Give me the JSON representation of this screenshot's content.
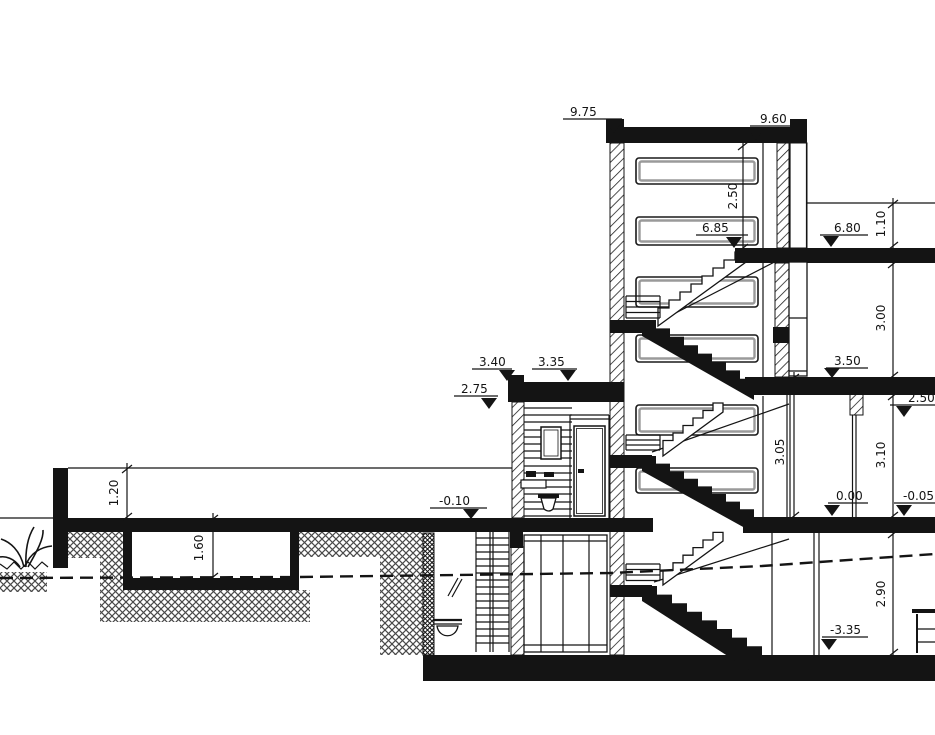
{
  "drawing": {
    "type": "architectural-section",
    "title": "building-cross-section",
    "ink_color": "#141414",
    "paper_color": "#ffffff",
    "labels": {
      "l975": "9.75",
      "l960": "9.60",
      "l685": "6.85",
      "l680": "6.80",
      "l350": "3.50",
      "l340": "3.40",
      "l335": "3.35",
      "l275": "2.75",
      "l250": "2.50",
      "l000": "0.00",
      "lm005": "-0.05",
      "lm010": "-0.10",
      "lm335": "-3.35"
    },
    "dims": {
      "d250": "2.50",
      "d110": "1.10",
      "d300": "3.00",
      "d305": "3.05",
      "d310": "3.10",
      "d290": "2.90",
      "d120": "1.20",
      "d160": "1.60"
    }
  }
}
